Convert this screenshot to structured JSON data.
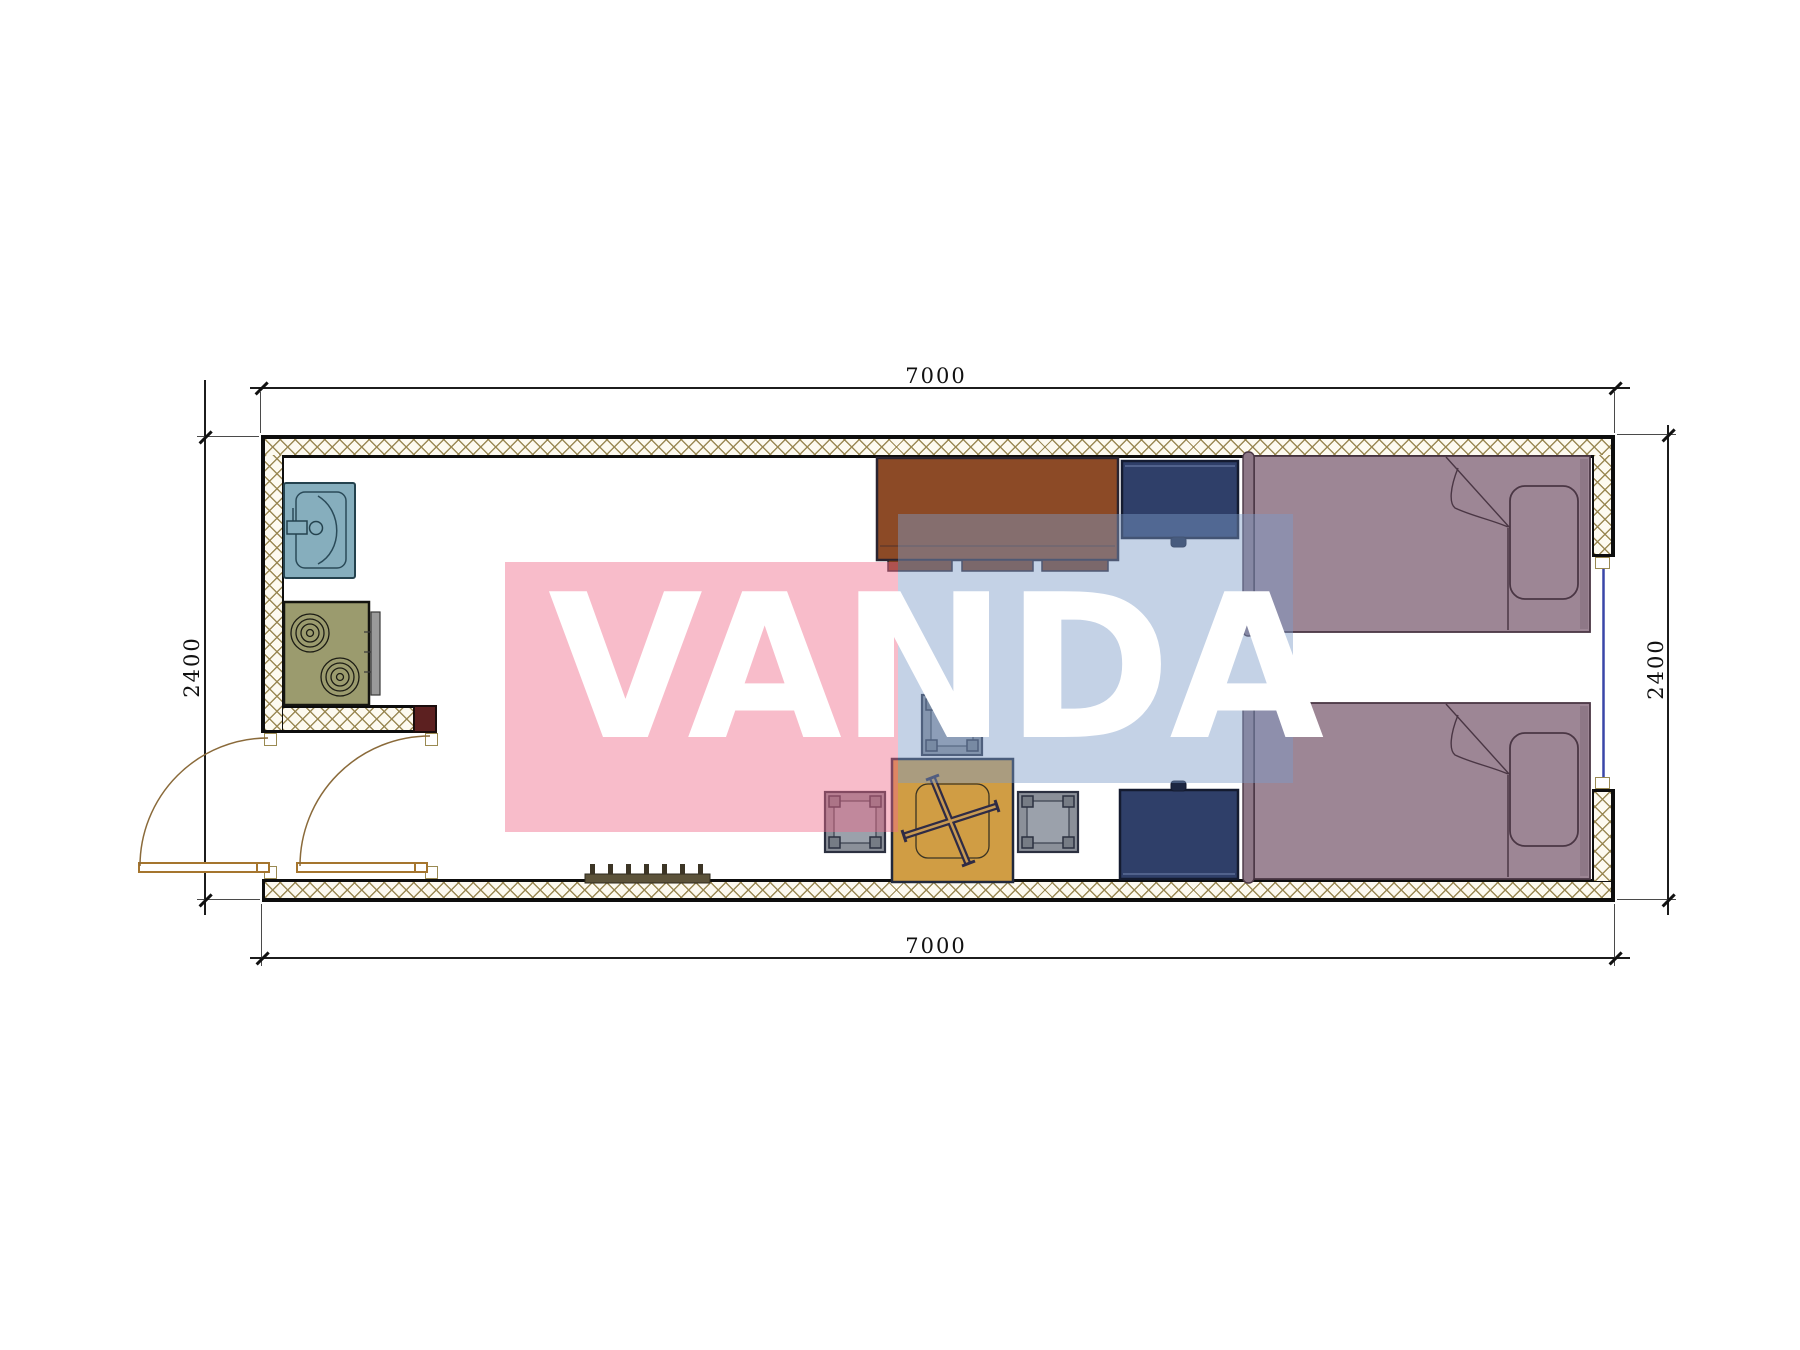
{
  "title": "Container house floor plan",
  "watermark": {
    "text": "VANDA",
    "pink_color": "#f06a8a",
    "blue_color": "#7d9cc8",
    "text_color": "#ffffff"
  },
  "dimensions": {
    "top": "7000",
    "bottom": "7000",
    "left": "2400",
    "right": "2400"
  },
  "plan": {
    "exterior_size_mm": {
      "width": 7000,
      "height": 2400
    },
    "fixtures": [
      {
        "name": "sink-unit",
        "color": "#86aebd"
      },
      {
        "name": "stove-two-burners",
        "color": "#9b9b6e"
      },
      {
        "name": "desk-cabinet",
        "color": "#8c4a26"
      },
      {
        "name": "nightstand",
        "color": "#2f3f69"
      },
      {
        "name": "wardrobe",
        "color": "#2f3f69"
      },
      {
        "name": "bed-top",
        "color": "#9d8695"
      },
      {
        "name": "bed-bottom",
        "color": "#9d8695"
      },
      {
        "name": "stool-top",
        "color": "#8b9099"
      },
      {
        "name": "stool-left",
        "color": "#8b9099"
      },
      {
        "name": "stool-right",
        "color": "#8b9099"
      },
      {
        "name": "square-table-x-base",
        "color": "#d09d44"
      },
      {
        "name": "peg-rack",
        "color": "#5c533a"
      },
      {
        "name": "entry-door-left",
        "swing": "quarter-arc"
      },
      {
        "name": "interior-door-vestibule",
        "swing": "quarter-arc"
      },
      {
        "name": "window-right",
        "color": "#3a46a8"
      }
    ],
    "wall_hatch_color": "#96844e",
    "wall_line_color": "#0d0d0d"
  }
}
